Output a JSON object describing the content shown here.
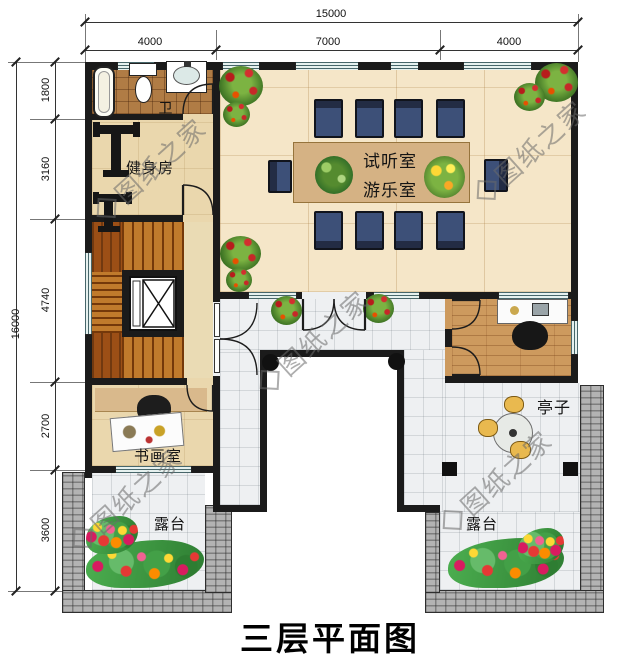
{
  "title": "三层平面图",
  "watermark": "图纸之家",
  "dims": {
    "top": {
      "total": "15000",
      "segments": [
        "4000",
        "7000",
        "4000"
      ]
    },
    "left": {
      "total": "16000",
      "segments": [
        "1800",
        "3160",
        "4740",
        "2700",
        "3600"
      ]
    }
  },
  "rooms": {
    "bathroom": "卫",
    "gym": "健身房",
    "media_line1": "试听室",
    "media_line2": "游乐室",
    "study": "书画室",
    "pavilion": "亭子",
    "terrace_left": "露台",
    "terrace_right": "露台"
  },
  "colors": {
    "wall": "#1b1b1b",
    "wood_light": "#f5e6c8",
    "tile": "#eef0f2",
    "tan": "#ead7ad",
    "bath_tile": "#b07c45",
    "stair": "#c07a2c",
    "office_wood": "#cd9a5e",
    "cobble": "#b3b3b3",
    "chair_navy": "#3d5078",
    "window_teal": "#e6f1ef",
    "table_wood": "#d5b284"
  }
}
